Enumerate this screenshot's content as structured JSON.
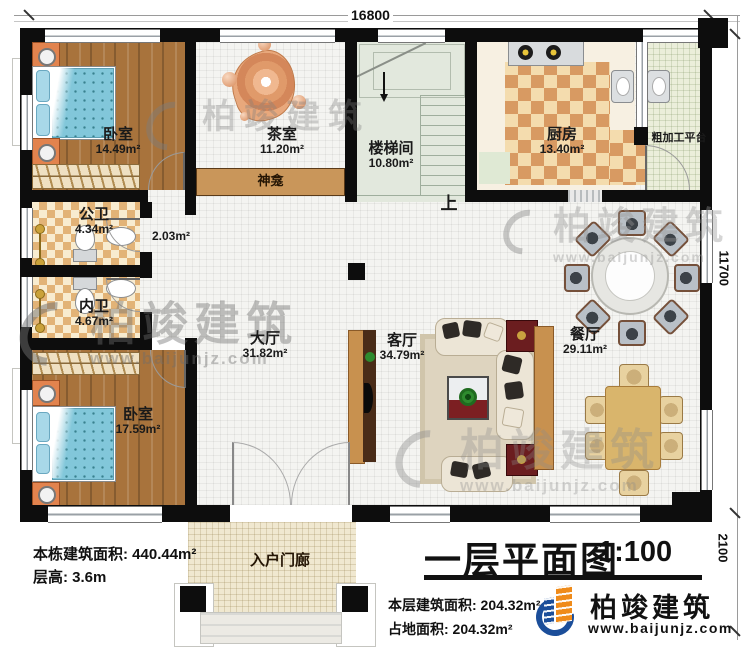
{
  "dimensions": {
    "top": "16800",
    "right": "11700",
    "bottom_right": "2100"
  },
  "rooms": {
    "bedroom1": {
      "name": "卧室",
      "area": "14.49m²"
    },
    "tea_room": {
      "name": "茶室",
      "area": "11.20m²"
    },
    "stairwell": {
      "name": "楼梯间",
      "area": "10.80m²"
    },
    "stairs_up": {
      "label": "上"
    },
    "kitchen": {
      "name": "厨房",
      "area": "13.40m²"
    },
    "prep_platform": {
      "name": "粗加工平台"
    },
    "shrine": {
      "name": "神龛"
    },
    "public_bath": {
      "name": "公卫",
      "area": "4.34m²"
    },
    "corridor": {
      "area": "2.03m²"
    },
    "inner_bath": {
      "name": "内卫",
      "area": "4.67m²"
    },
    "bedroom2": {
      "name": "卧室",
      "area": "17.59m²"
    },
    "main_hall": {
      "name": "大厅",
      "area": "31.82m²"
    },
    "living_room": {
      "name": "客厅",
      "area": "34.79m²"
    },
    "dining_room": {
      "name": "餐厅",
      "area": "29.11m²"
    },
    "entrance_porch": {
      "name": "入户门廊"
    }
  },
  "annotations": {
    "building_area": "本栋建筑面积: 440.44m²",
    "floor_height": "层高: 3.6m",
    "floor_area": "本层建筑面积: 204.32m²",
    "footprint_area": "占地面积: 204.32m²"
  },
  "title": {
    "text": "一层平面图",
    "scale": "1:100"
  },
  "logo": {
    "name": "柏竣建筑",
    "url": "www.baijunjz.com"
  },
  "watermark": {
    "name": "柏竣建筑",
    "url": "www.baijunjz.com"
  },
  "colors": {
    "wall": "#0d0d0d",
    "wood": "#a8733c",
    "accent_blue": "#1b4e9a",
    "accent_orange": "#ef8b1a"
  }
}
